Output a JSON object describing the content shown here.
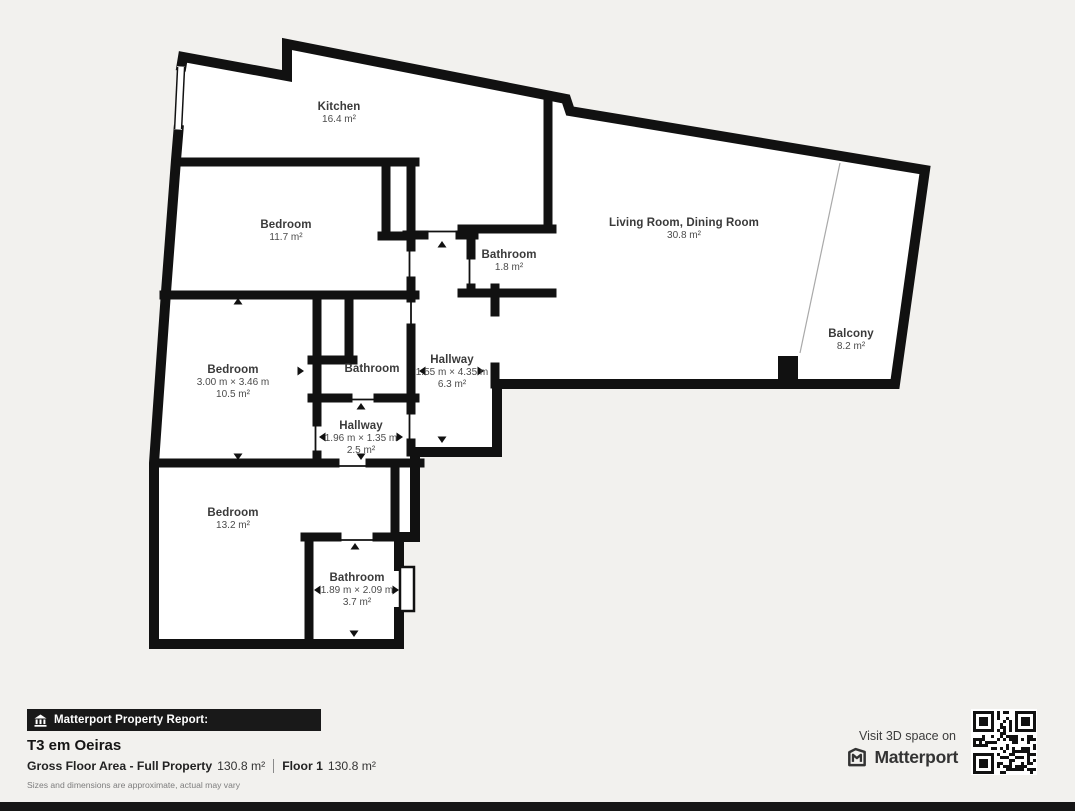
{
  "plan": {
    "rooms": {
      "kitchen": {
        "name": "Kitchen",
        "area": "16.4 m²"
      },
      "bedroom_top": {
        "name": "Bedroom",
        "area": "11.7 m²"
      },
      "bathroom_top": {
        "name": "Bathroom",
        "area": "1.8 m²"
      },
      "living": {
        "name": "Living Room, Dining Room",
        "area": "30.8 m²"
      },
      "balcony": {
        "name": "Balcony",
        "area": "8.2 m²"
      },
      "bedroom_mid": {
        "name": "Bedroom",
        "dimensions": "3.00 m × 3.46 m",
        "area": "10.5 m²"
      },
      "bathroom_mid": {
        "name": "Bathroom"
      },
      "hallway_main": {
        "name": "Hallway",
        "dimensions": "1.55 m × 4.35 m",
        "area": "6.3 m²"
      },
      "hallway_small": {
        "name": "Hallway",
        "dimensions": "1.96 m × 1.35 m",
        "area": "2.5 m²"
      },
      "bedroom_bottom": {
        "name": "Bedroom",
        "area": "13.2 m²"
      },
      "bathroom_bottom": {
        "name": "Bathroom",
        "dimensions": "1.89 m × 2.09 m",
        "area": "3.7 m²"
      }
    }
  },
  "footer": {
    "badge_label": "Matterport Property Report:",
    "property_title": "T3 em Oeiras",
    "gross_label": "Gross Floor Area - Full Property",
    "gross_value": "130.8 m²",
    "floor_label": "Floor 1",
    "floor_value": "130.8 m²",
    "disclaimer": "Sizes and dimensions are approximate, actual may vary"
  },
  "cta": {
    "visit_text": "Visit 3D space on",
    "brand": "Matterport",
    "qr_icon": "qr-code"
  },
  "colors": {
    "background": "#f2f1ee",
    "wall": "#111111",
    "floor": "#ffffff",
    "label_text": "#3a3a3a",
    "badge_bg": "#191919",
    "brand_text": "#333333"
  }
}
